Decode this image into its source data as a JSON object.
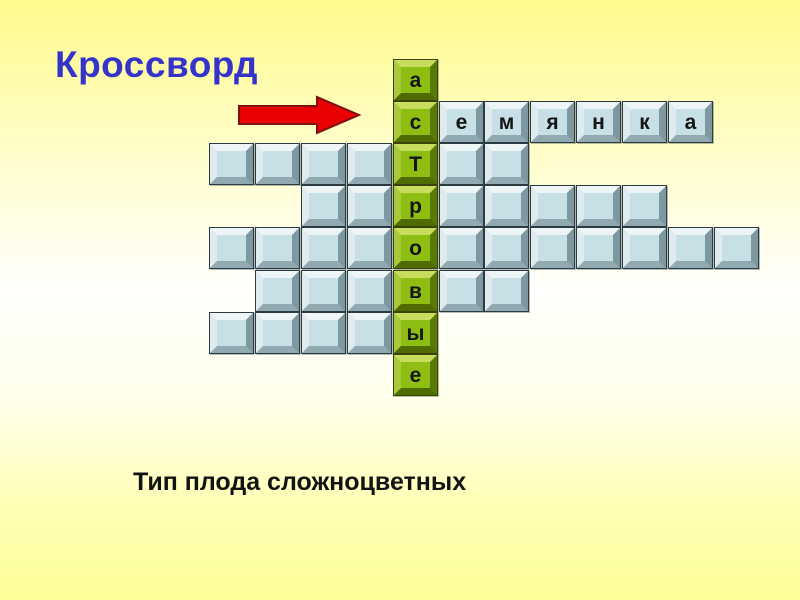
{
  "title": "Кроссворд",
  "question": "Тип плода сложноцветных",
  "icons": {
    "arrow": "arrow-right-icon"
  },
  "colors": {
    "background_top": "#fffa8c",
    "background_middle": "#fffffd",
    "background_bottom": "#ffff99",
    "title_text": "#3434cd",
    "question_text": "#131313",
    "arrow_fill": "#e90000",
    "arrow_outline": "#7d1010",
    "green_cell": "#8dbe11",
    "green_bevel_light": "#c8dc5d",
    "green_bevel_dark": "#4e6c00",
    "blue_cell": "#c7e0e6",
    "blue_bevel_light": "#edf5f6",
    "blue_bevel_dark": "#7e98a2",
    "letter_text": "#151515"
  },
  "grid": {
    "columns": 12,
    "key_column": 5,
    "rows": [
      {
        "cells": [
          {
            "c": 5,
            "t": "g",
            "ch": "а"
          }
        ]
      },
      {
        "cells": [
          {
            "c": 5,
            "t": "g",
            "ch": "с"
          },
          {
            "c": 6,
            "t": "b",
            "ch": "е"
          },
          {
            "c": 7,
            "t": "b",
            "ch": "м"
          },
          {
            "c": 8,
            "t": "b",
            "ch": "я"
          },
          {
            "c": 9,
            "t": "b",
            "ch": "н"
          },
          {
            "c": 10,
            "t": "b",
            "ch": "к"
          },
          {
            "c": 11,
            "t": "b",
            "ch": "а"
          }
        ]
      },
      {
        "cells": [
          {
            "c": 1,
            "t": "b",
            "ch": ""
          },
          {
            "c": 2,
            "t": "b",
            "ch": ""
          },
          {
            "c": 3,
            "t": "b",
            "ch": ""
          },
          {
            "c": 4,
            "t": "b",
            "ch": ""
          },
          {
            "c": 5,
            "t": "g",
            "ch": "Т"
          },
          {
            "c": 6,
            "t": "b",
            "ch": ""
          },
          {
            "c": 7,
            "t": "b",
            "ch": ""
          }
        ]
      },
      {
        "cells": [
          {
            "c": 3,
            "t": "b",
            "ch": ""
          },
          {
            "c": 4,
            "t": "b",
            "ch": ""
          },
          {
            "c": 5,
            "t": "g",
            "ch": "р"
          },
          {
            "c": 6,
            "t": "b",
            "ch": ""
          },
          {
            "c": 7,
            "t": "b",
            "ch": ""
          },
          {
            "c": 8,
            "t": "b",
            "ch": ""
          },
          {
            "c": 9,
            "t": "b",
            "ch": ""
          },
          {
            "c": 10,
            "t": "b",
            "ch": ""
          }
        ]
      },
      {
        "cells": [
          {
            "c": 1,
            "t": "b",
            "ch": ""
          },
          {
            "c": 2,
            "t": "b",
            "ch": ""
          },
          {
            "c": 3,
            "t": "b",
            "ch": ""
          },
          {
            "c": 4,
            "t": "b",
            "ch": ""
          },
          {
            "c": 5,
            "t": "g",
            "ch": "о"
          },
          {
            "c": 6,
            "t": "b",
            "ch": ""
          },
          {
            "c": 7,
            "t": "b",
            "ch": ""
          },
          {
            "c": 8,
            "t": "b",
            "ch": ""
          },
          {
            "c": 9,
            "t": "b",
            "ch": ""
          },
          {
            "c": 10,
            "t": "b",
            "ch": ""
          },
          {
            "c": 11,
            "t": "b",
            "ch": ""
          },
          {
            "c": 12,
            "t": "b",
            "ch": ""
          }
        ]
      },
      {
        "cells": [
          {
            "c": 2,
            "t": "b",
            "ch": ""
          },
          {
            "c": 3,
            "t": "b",
            "ch": ""
          },
          {
            "c": 4,
            "t": "b",
            "ch": ""
          },
          {
            "c": 5,
            "t": "g",
            "ch": "в"
          },
          {
            "c": 6,
            "t": "b",
            "ch": ""
          },
          {
            "c": 7,
            "t": "b",
            "ch": ""
          }
        ]
      },
      {
        "cells": [
          {
            "c": 1,
            "t": "b",
            "ch": ""
          },
          {
            "c": 2,
            "t": "b",
            "ch": ""
          },
          {
            "c": 3,
            "t": "b",
            "ch": ""
          },
          {
            "c": 4,
            "t": "b",
            "ch": ""
          },
          {
            "c": 5,
            "t": "g",
            "ch": "ы"
          }
        ]
      },
      {
        "cells": [
          {
            "c": 5,
            "t": "g",
            "ch": "е"
          }
        ]
      }
    ]
  }
}
